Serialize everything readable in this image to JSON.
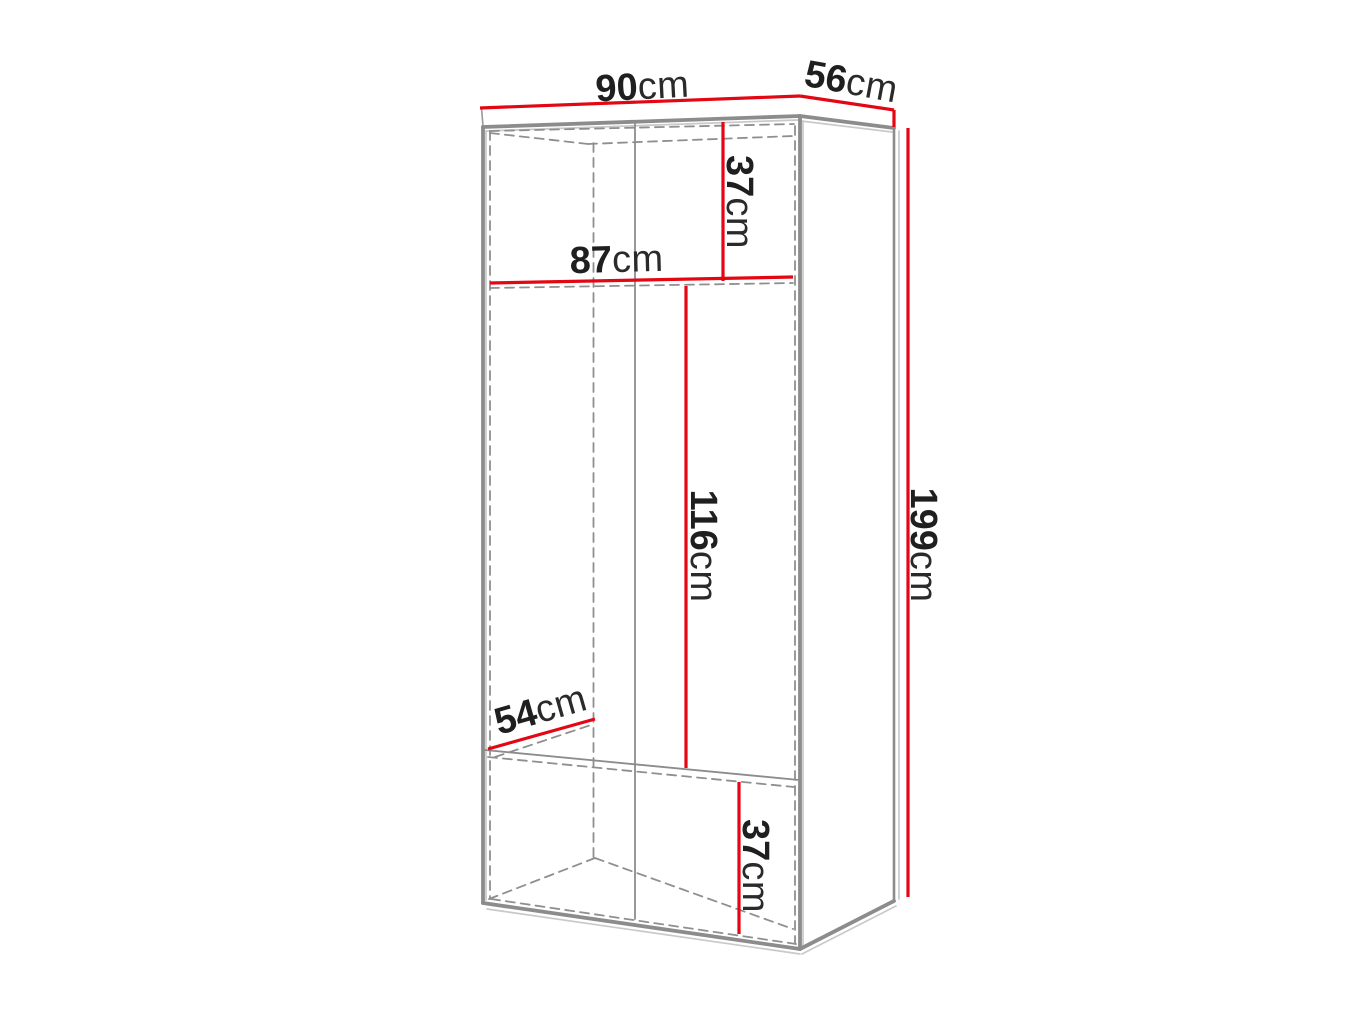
{
  "diagram": {
    "kind": "furniture-dimension-drawing",
    "subject": "wardrobe",
    "colors": {
      "dimension_line": "#e30613",
      "outline": "#8c8c8c",
      "hidden_edge": "#8f8f8f",
      "label_text": "#1f1f1f",
      "background": "#ffffff"
    },
    "dimensions": {
      "width": {
        "value": "90",
        "unit": "cm"
      },
      "depth": {
        "value": "56",
        "unit": "cm"
      },
      "height": {
        "value": "199",
        "unit": "cm"
      },
      "upper_section_height": {
        "value": "37",
        "unit": "cm"
      },
      "interior_width": {
        "value": "87",
        "unit": "cm"
      },
      "interior_height": {
        "value": "116",
        "unit": "cm"
      },
      "interior_depth": {
        "value": "54",
        "unit": "cm"
      },
      "lower_section_height": {
        "value": "37",
        "unit": "cm"
      }
    }
  }
}
